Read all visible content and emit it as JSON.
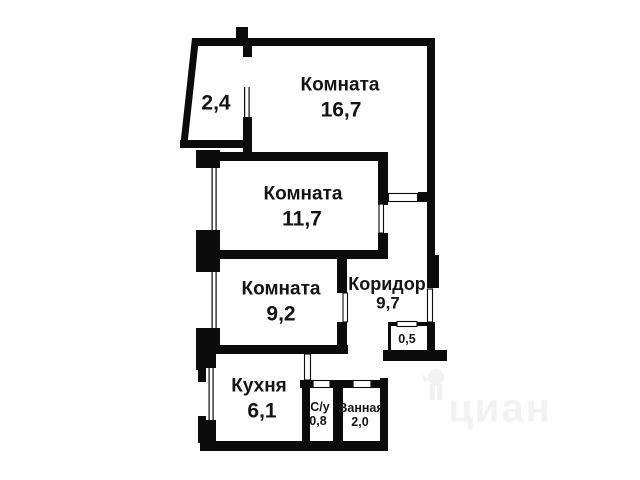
{
  "plan_title": "apartment-floor-plan",
  "rooms": {
    "room1": {
      "label": "Комната",
      "area": "16,7"
    },
    "room2": {
      "label": "Комната",
      "area": "11,7"
    },
    "room3": {
      "label": "Комната",
      "area": "9,2"
    },
    "corridor": {
      "label": "Коридор",
      "area": "9,7"
    },
    "closet": {
      "area": "0,5"
    },
    "kitchen": {
      "label": "Кухня",
      "area": "6,1"
    },
    "wc": {
      "label": "С/у",
      "area": "0,8"
    },
    "bath": {
      "label": "Ванная",
      "area": "2,0"
    },
    "balcony": {
      "area": "2,4"
    }
  },
  "watermark": {
    "text": "циан"
  },
  "colors": {
    "wall-color": "#0b0b0b",
    "text-color": "#141414",
    "watermark-color": "#f2f2f2",
    "background": "#ffffff"
  }
}
